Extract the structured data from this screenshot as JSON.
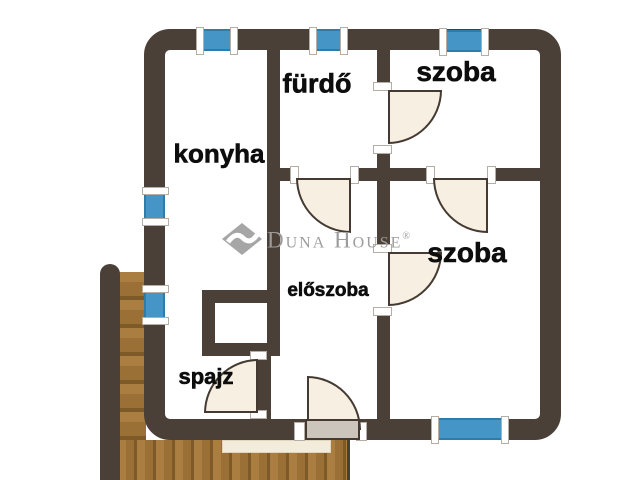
{
  "title": "Lakás alaprajz (apartment floor plan)",
  "rooms": [
    {
      "id": "konyha",
      "label": "konyha"
    },
    {
      "id": "furdo",
      "label": "fürdő"
    },
    {
      "id": "szoba-top",
      "label": "szoba"
    },
    {
      "id": "szoba-right",
      "label": "szoba"
    },
    {
      "id": "eloszoba",
      "label": "előszoba"
    },
    {
      "id": "spajz",
      "label": "spajz"
    }
  ],
  "watermark": {
    "brand": "Duna House",
    "registered": "®"
  },
  "features": {
    "windows": [
      "konyha top wall",
      "fürdő top wall",
      "szoba top wall",
      "konyha left wall",
      "left wall lower",
      "szoba bottom wall"
    ],
    "doors": [
      "fürdő to szoba-top",
      "szoba-top to szoba-right",
      "fürdő to előszoba",
      "előszoba to szoba-right",
      "spajz doorway",
      "entrance from deck"
    ],
    "outdoor": [
      "wooden deck with stairs along left and bottom",
      "doormat at entrance"
    ]
  },
  "colors": {
    "wall": "#4b4037",
    "window": "#4596c6",
    "windowBorder": "#2e7ca8",
    "door": "#f6efe2",
    "doorEdge": "#453a31",
    "leaf": "#ccc5bc",
    "mat": "#f3ecda",
    "wood": "#9a7036",
    "watermark": "#9c9c9c",
    "label": "#0d0d0d"
  }
}
